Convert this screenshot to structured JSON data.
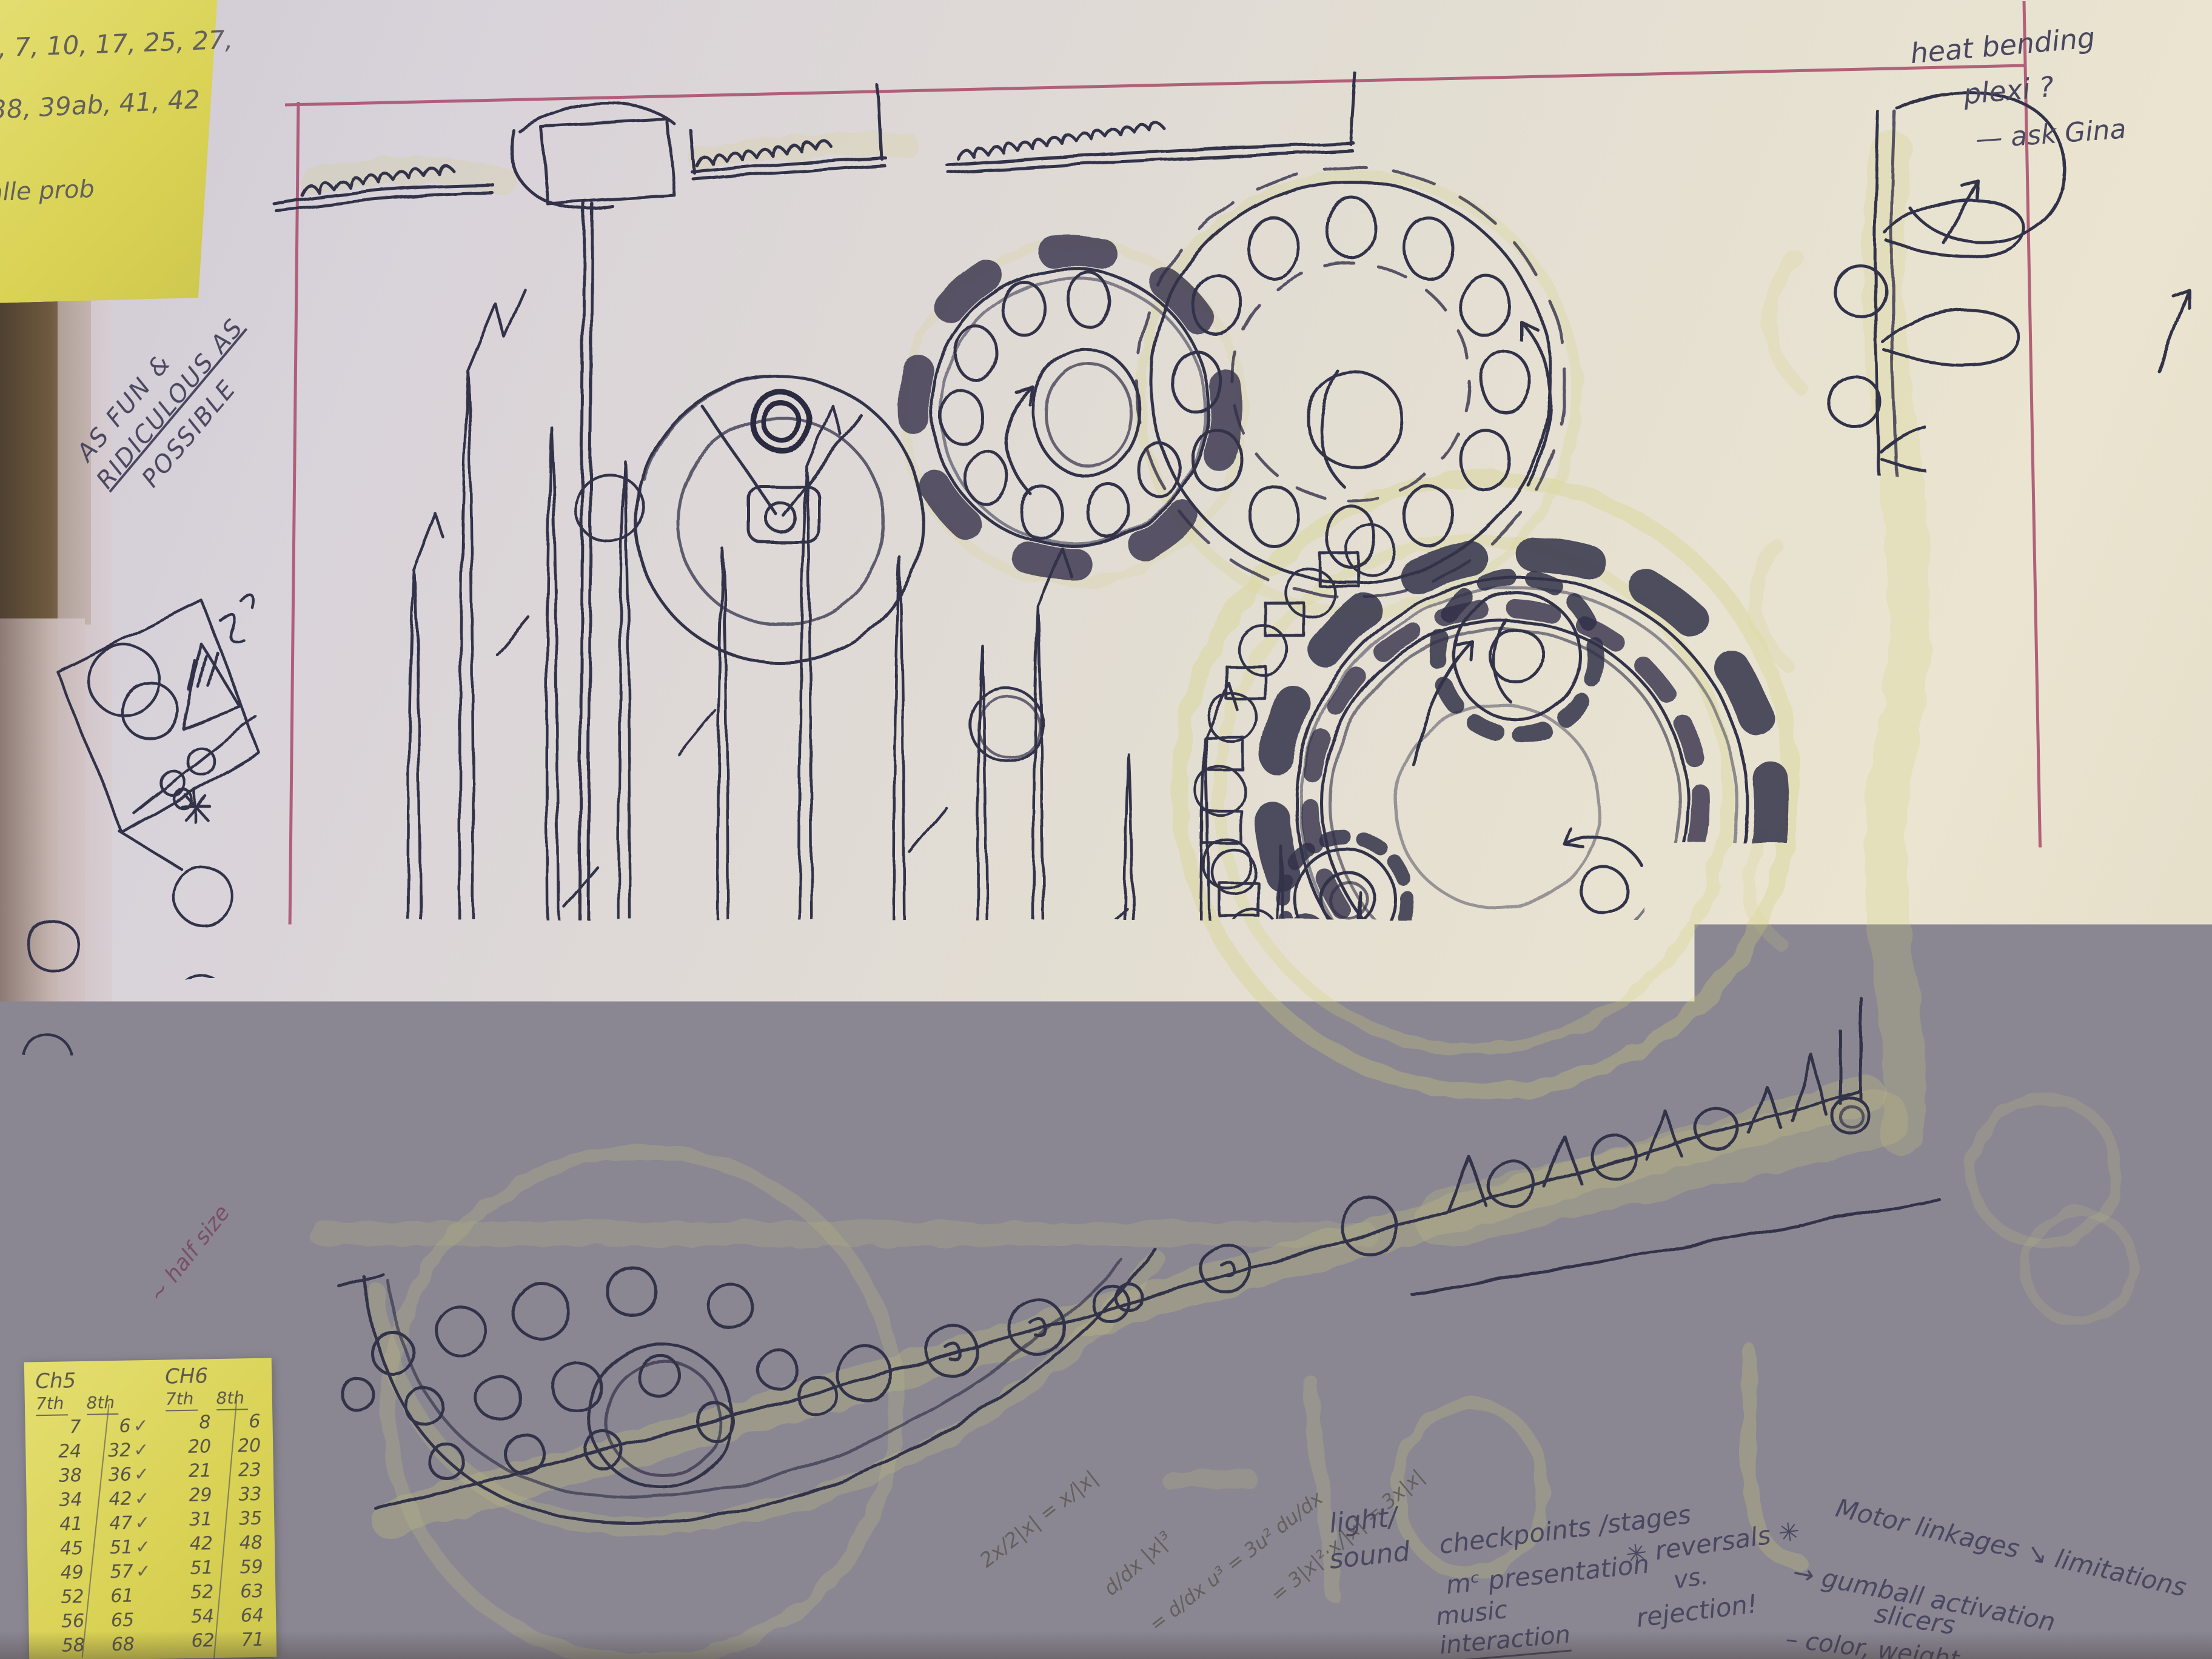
{
  "photo_caption": "hand-drawn kinetic machine concept sketch on paper with sticky notes",
  "colors": {
    "paper_cool": "#d9d3da",
    "paper_warm": "#eae4d0",
    "ink": "#32314a",
    "highlighter": "#d4d277",
    "margin_line_pink": "#a84a6a",
    "sticky_yellow": "#d9d254",
    "graphite": "#63605c",
    "book_cover_brown": "#6f5a40",
    "corner_gray": "#35343c"
  },
  "sticky_top_left": {
    "lines": [
      "5, 7, 10, 17, 25, 27,",
      "38, 39ab, 41, 42",
      "alle prob"
    ]
  },
  "margin_note": {
    "lines": [
      "AS FUN &",
      "RIDICULOUS AS",
      "POSSIBLE"
    ]
  },
  "corner_note": {
    "lines": [
      "heat bending",
      "plexi ?",
      "— ask Gina"
    ]
  },
  "half_size_note": "~ half size",
  "math_scribbles": [
    "2x/2|x| = x/|x|",
    "d/dx |x|³",
    "= d/dx u³ = 3u² du/dx",
    "= 3|x|²·x/|x| = 3x|x|"
  ],
  "bottom_notes": {
    "light_sound": [
      "light/",
      "sound"
    ],
    "checkpoints": [
      "checkpoints /stages",
      "mᶜ presentation",
      "music",
      "interaction"
    ],
    "reversals": [
      "✳ reversals ✳",
      "vs.",
      "rejection!"
    ],
    "motor": [
      "Motor linkages ↘ limitations",
      "→ gumball activation",
      "slicers",
      "– color, weight"
    ]
  },
  "sticky_bottom": {
    "left_table": {
      "title": "Ch5",
      "cols": [
        "7th",
        "8th"
      ],
      "rows": [
        [
          "7",
          "6",
          "✓"
        ],
        [
          "24",
          "32",
          "✓"
        ],
        [
          "38",
          "36",
          "✓"
        ],
        [
          "34",
          "42",
          "✓"
        ],
        [
          "41",
          "47",
          "✓"
        ],
        [
          "45",
          "51",
          "✓"
        ],
        [
          "49",
          "57",
          "✓"
        ],
        [
          "52",
          "61",
          ""
        ],
        [
          "56",
          "65",
          ""
        ],
        [
          "58",
          "68",
          ""
        ]
      ]
    },
    "right_table": {
      "title": "CH6",
      "cols": [
        "7th",
        "8th"
      ],
      "rows": [
        [
          "8",
          "6",
          ""
        ],
        [
          "20",
          "20",
          ""
        ],
        [
          "21",
          "23",
          ""
        ],
        [
          "29",
          "33",
          ""
        ],
        [
          "31",
          "35",
          ""
        ],
        [
          "42",
          "48",
          ""
        ],
        [
          "51",
          "59",
          ""
        ],
        [
          "52",
          "63",
          ""
        ],
        [
          "54",
          "64",
          ""
        ],
        [
          "62",
          "71",
          ""
        ]
      ]
    }
  },
  "sketch_elements": [
    "serrated-track",
    "hanging-box",
    "pendulum-rod-and-bob",
    "target-clock-dial",
    "spike-forest",
    "geneva-wheel",
    "holed-disc-wheel",
    "gear-train-cluster",
    "bucket-chain",
    "comb-rail",
    "ball-bowl",
    "ball-ramp",
    "screw-lift-helix",
    "slider-box-icon",
    "vertical-slider-icon",
    "notched-ring-icon",
    "cup-with-ball-icon",
    "hanging-fork",
    "hanging-spiral",
    "margin-thumbnail-frames",
    "margin-circles"
  ]
}
